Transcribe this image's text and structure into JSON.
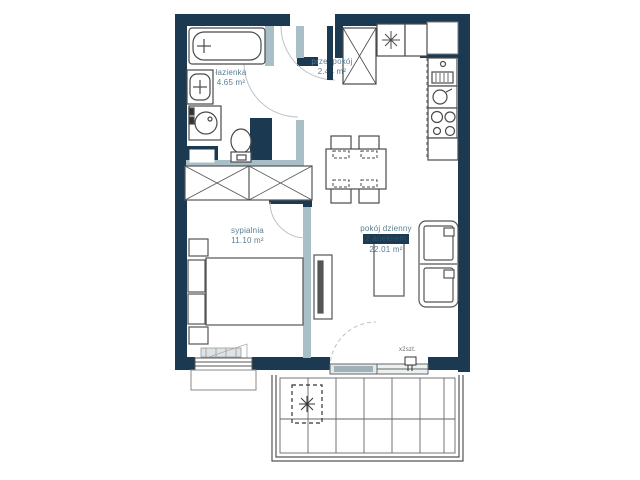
{
  "title": "apartment-floor-plan",
  "rooms": {
    "bathroom": {
      "name": "łazienka",
      "area": "4.65 m²"
    },
    "hallway": {
      "name": "przedpokój",
      "area": "2.44 m²"
    },
    "bedroom": {
      "name": "sypialnia",
      "area": "11.10 m²"
    },
    "living_room": {
      "name": "pokój dzienny",
      "subtitle": "z aneksem",
      "area": "22.01 m²"
    }
  },
  "annotations": {
    "balcony_socket_note": "x2szt."
  },
  "colors": {
    "wall": "#1b3a52",
    "partition": "#a9bfc8",
    "line": "#4a4a4a",
    "label_text": "#5a7e92",
    "highlight_bg": "#1c3b52",
    "radiator_fill": "#dfe3e5"
  },
  "fixtures": [
    "bathtub",
    "washbasin",
    "washing-machine",
    "toilet",
    "plumbing-shaft",
    "hallway-wardrobe",
    "kitchen-sink",
    "refrigerator",
    "cooktop",
    "kitchen-counter",
    "dining-table",
    "chairs",
    "sofa",
    "side-table",
    "tv-cabinet",
    "double-bed",
    "nightstands",
    "bedroom-wardrobe",
    "radiator",
    "balcony",
    "air-conditioner-unit",
    "electrical-socket"
  ]
}
